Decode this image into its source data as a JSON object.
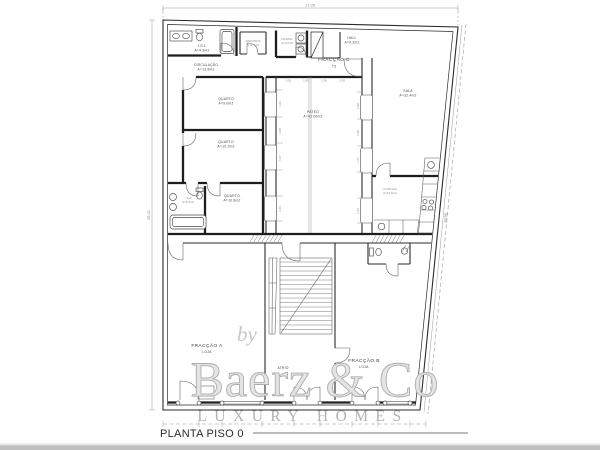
{
  "meta": {
    "drawing_title": "PLANTA PISO 0"
  },
  "watermark": {
    "by": "by",
    "brand": "Baerz & Co",
    "tagline": "LUXURY HOMES"
  },
  "dimensions": {
    "top": "17.35",
    "left": "28.41",
    "right": "29.96",
    "patio_top": [
      "1.06",
      "1.80",
      "1.90",
      "1.90"
    ],
    "patio_left": [
      "1.03",
      "3.98",
      "1.07",
      "3.46"
    ],
    "patio_right": [
      "0.95",
      "3.98",
      "1.07",
      "3.46"
    ]
  },
  "rooms": {
    "is1": {
      "name": "I.S.1",
      "area": "A=4.5m2"
    },
    "arrumos": {
      "name": "ARRUMOS",
      "area": "A=1.7m2"
    },
    "lavand": {
      "name": "LAVAND.",
      "area": "A=3.8m2"
    },
    "hall": {
      "name": "HALL",
      "area": "A=9.2m2"
    },
    "circulacao": {
      "name": "CIRCULAÇÃO",
      "area": "A=13.9m2"
    },
    "quarto1": {
      "name": "QUARTO",
      "area": "A=9.0m2"
    },
    "quarto2": {
      "name": "QUARTO",
      "area": "A=10.2m2"
    },
    "quarto3": {
      "name": "QUARTO",
      "area": "A=10.8m2"
    },
    "is2": {
      "name": "I.S.2",
      "area": "A=5.0m2"
    },
    "pateo": {
      "name": "PATEO",
      "area": "A=42.00m2"
    },
    "sala": {
      "name": "SALA",
      "area": "A=32.4m2"
    },
    "cozinha": {
      "name": "COZINHA",
      "area": "A=16.8m2"
    }
  },
  "fractions": {
    "c": {
      "name": "FRACÇÃO C",
      "type": "T3"
    },
    "a": {
      "name": "FRACÇÃO A",
      "type": "LOJA"
    },
    "b": {
      "name": "FRACÇÃO B",
      "type": "LOJA"
    }
  },
  "labels": {
    "atrio": "ATRIO"
  }
}
